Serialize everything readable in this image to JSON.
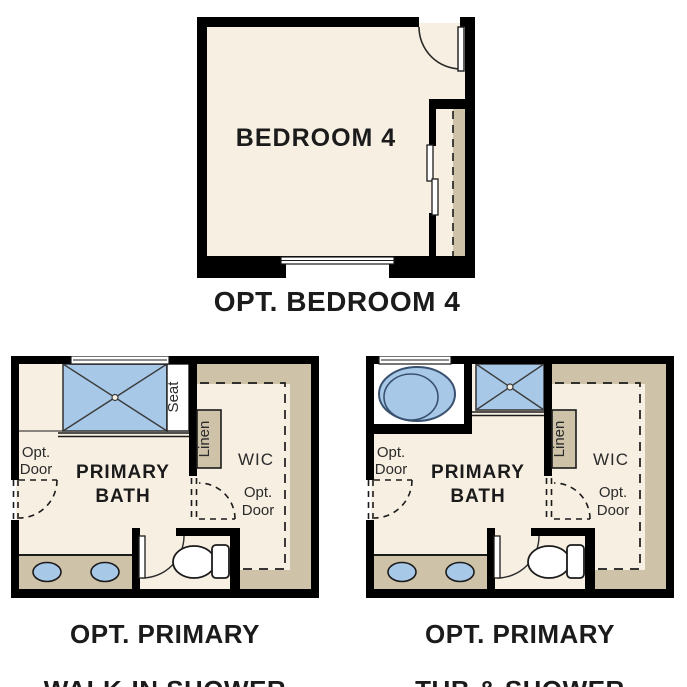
{
  "colors": {
    "wall": "#000000",
    "floor": "#f7efe2",
    "cabinet": "#cec2a8",
    "fixture_blue": "#a8c8e8",
    "fixture_stroke": "#3a5270",
    "line": "#2b2b2b",
    "text": "#1b1b1b",
    "background": "#ffffff"
  },
  "bedroom_plan": {
    "room_label": "BEDROOM 4",
    "caption": "OPT. BEDROOM 4"
  },
  "shower_plan": {
    "room_line1": "PRIMARY",
    "room_line2": "BATH",
    "wic_label": "WIC",
    "seat_label": "Seat",
    "linen_label": "Linen",
    "opt_door_left_line1": "Opt.",
    "opt_door_left_line2": "Door",
    "opt_door_right_line1": "Opt.",
    "opt_door_right_line2": "Door",
    "caption_line1": "OPT. PRIMARY",
    "caption_line2": "WALK-IN SHOWER"
  },
  "tub_plan": {
    "room_line1": "PRIMARY",
    "room_line2": "BATH",
    "wic_label": "WIC",
    "linen_label": "Linen",
    "opt_door_left_line1": "Opt.",
    "opt_door_left_line2": "Door",
    "opt_door_right_line1": "Opt.",
    "opt_door_right_line2": "Door",
    "caption_line1": "OPT. PRIMARY",
    "caption_line2": "TUB & SHOWER"
  }
}
